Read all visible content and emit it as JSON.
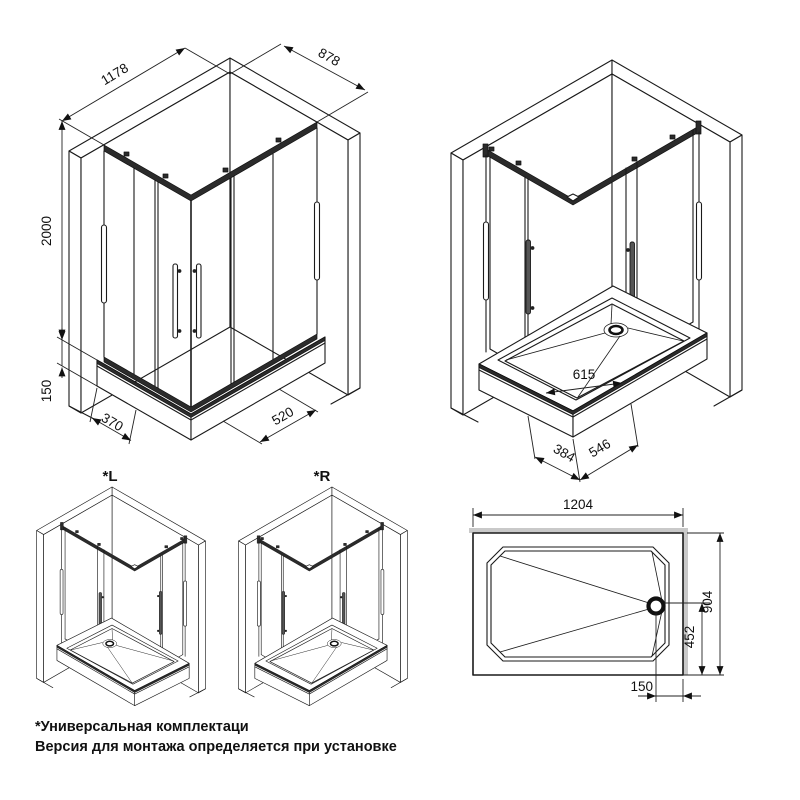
{
  "meta": {
    "kind": "Shower enclosure installation drawing"
  },
  "closed_view": {
    "width": "1178",
    "depth": "878",
    "height": "2000",
    "tray_height": "150",
    "left_segment": "370",
    "right_segment": "520"
  },
  "open_view": {
    "inner_width": "615",
    "left_segment": "384",
    "right_segment": "546"
  },
  "variants": {
    "left_label": "*L",
    "right_label": "*R"
  },
  "tray_plan": {
    "width": "1204",
    "depth": "904",
    "drain_from_bottom": "452",
    "drain_from_right": "150"
  },
  "notes": {
    "line1": "*Универсальная комплектаци",
    "line2": "Версия для монтажа определяется при установке"
  },
  "colors": {
    "line": "#1a1a1a",
    "rail": "#2b2b2b",
    "shadow": "#c9c9c9",
    "background": "#ffffff"
  }
}
